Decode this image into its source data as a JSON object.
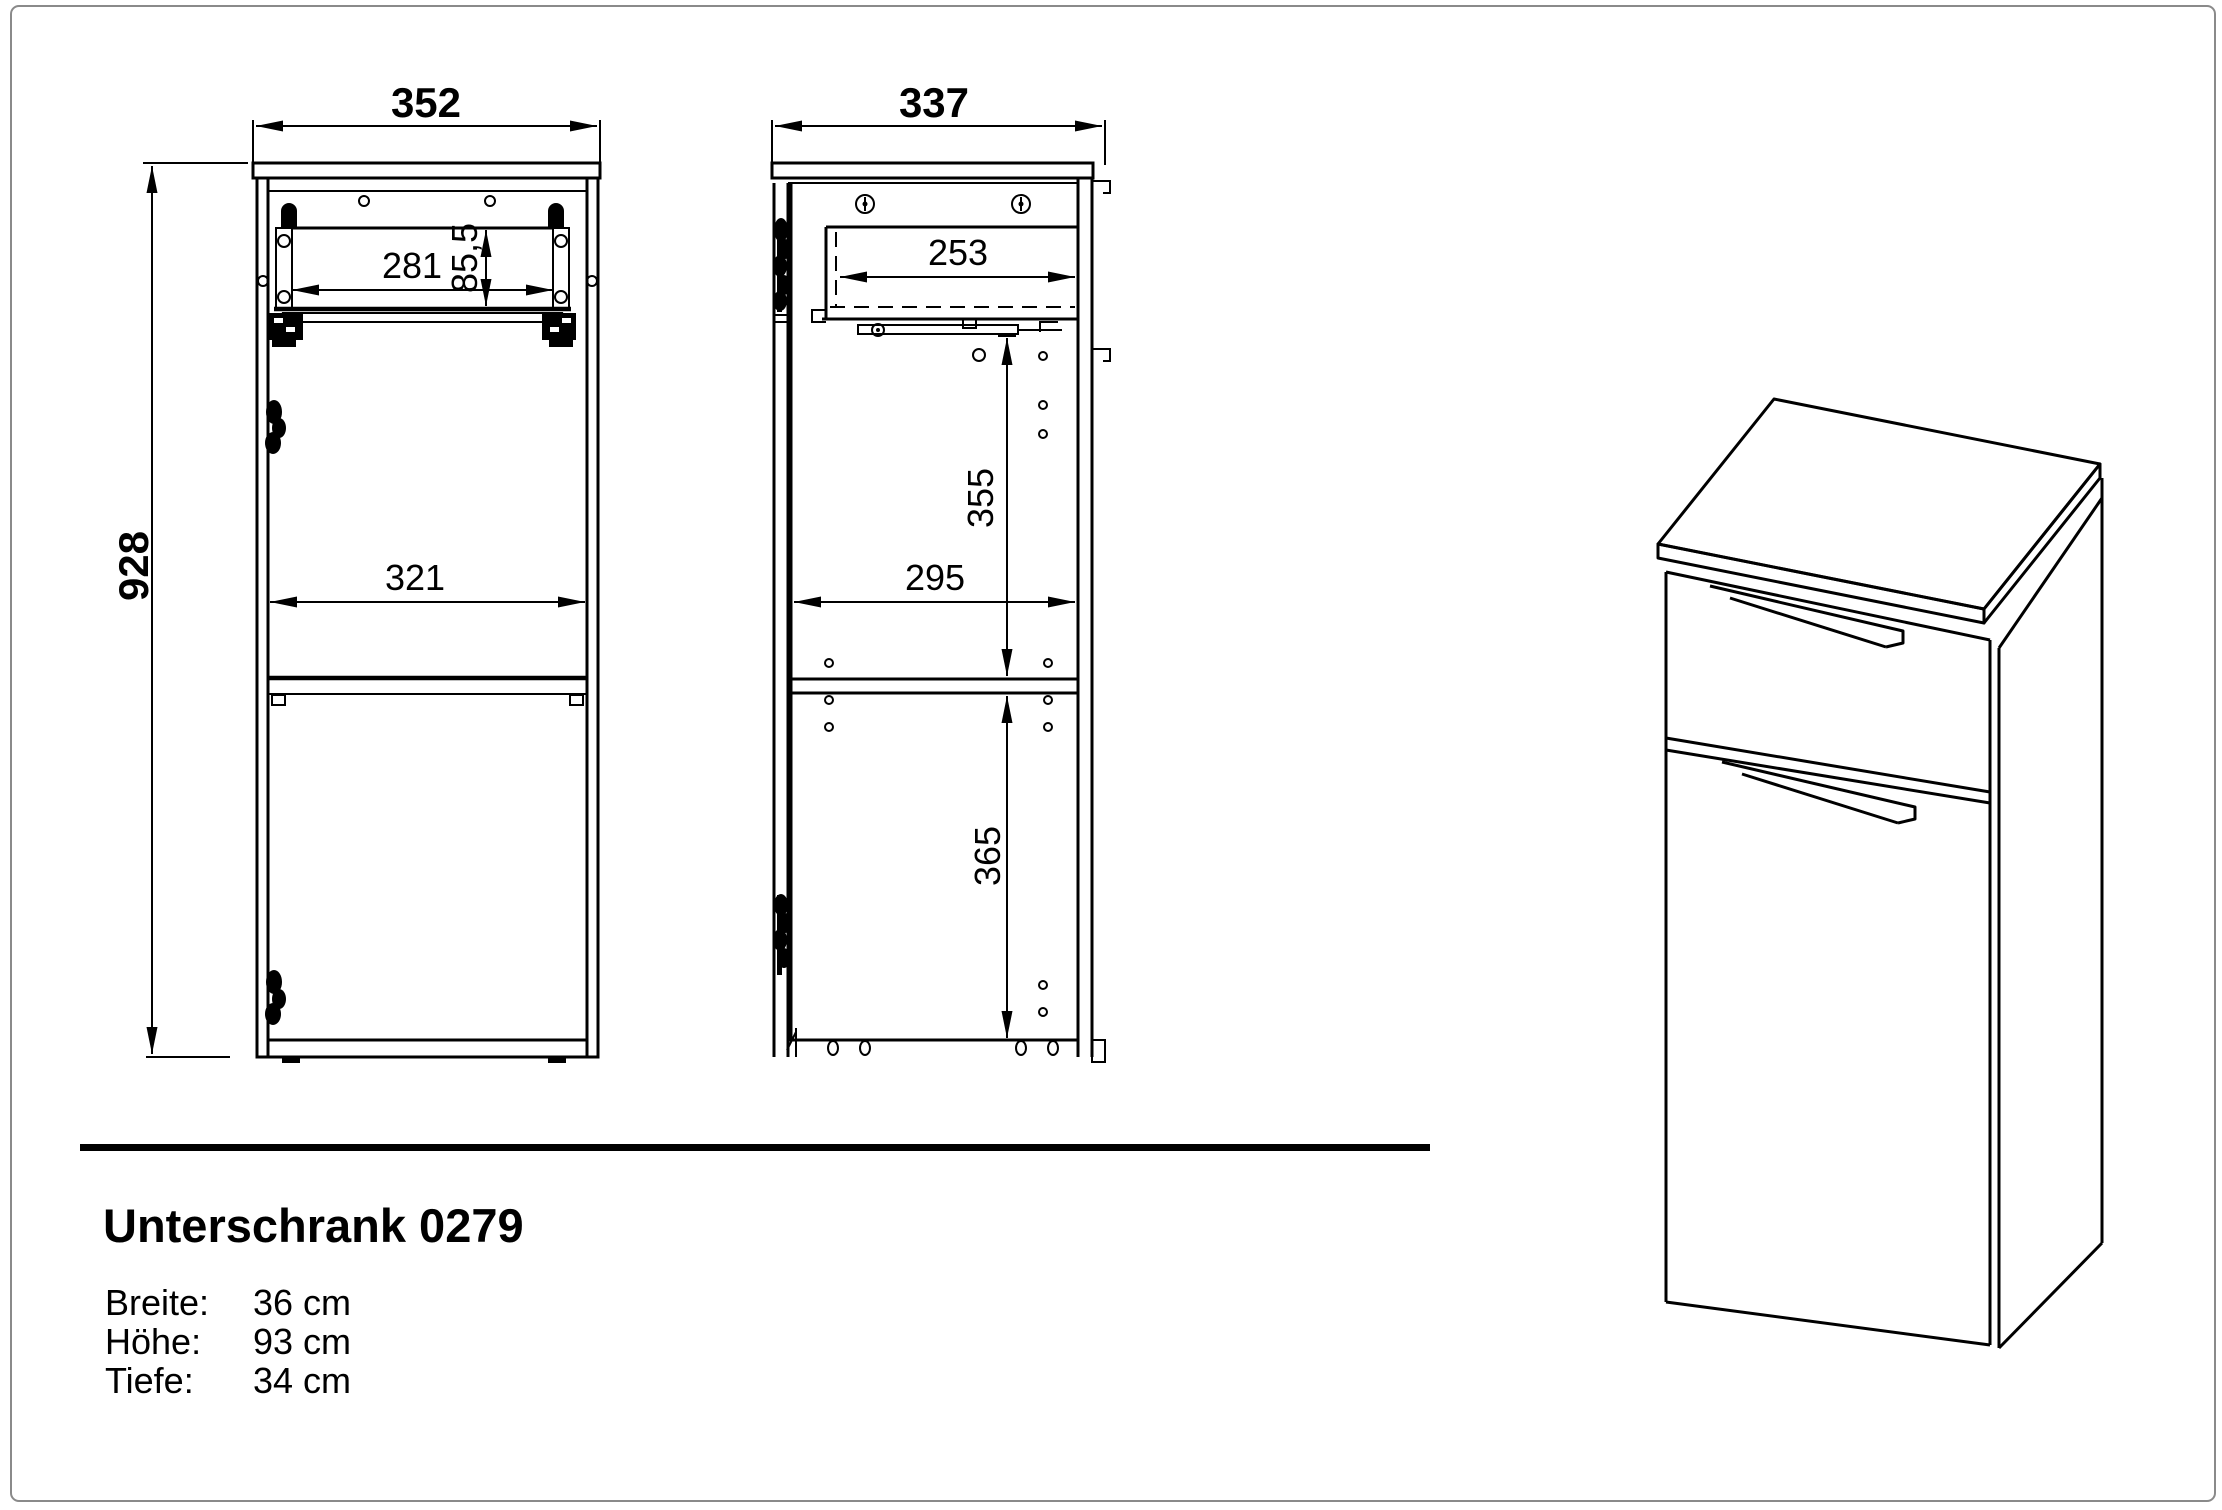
{
  "page": {
    "bg": "#ffffff",
    "border_color": "#8a8a8a",
    "line_color": "#000000"
  },
  "title": "Unterschrank 0279",
  "specs": [
    {
      "label": "Breite:",
      "value": "36 cm"
    },
    {
      "label": "Höhe:",
      "value": "93 cm"
    },
    {
      "label": "Tiefe:",
      "value": "34 cm"
    }
  ],
  "dimensions": {
    "front_width": "352",
    "front_height": "928",
    "front_drawer_width": "281",
    "front_drawer_height": "85,5",
    "front_interior_width": "321",
    "side_depth": "337",
    "side_drawer_depth": "253",
    "side_upper_height": "355",
    "side_interior_depth": "295",
    "side_lower_height": "365"
  }
}
